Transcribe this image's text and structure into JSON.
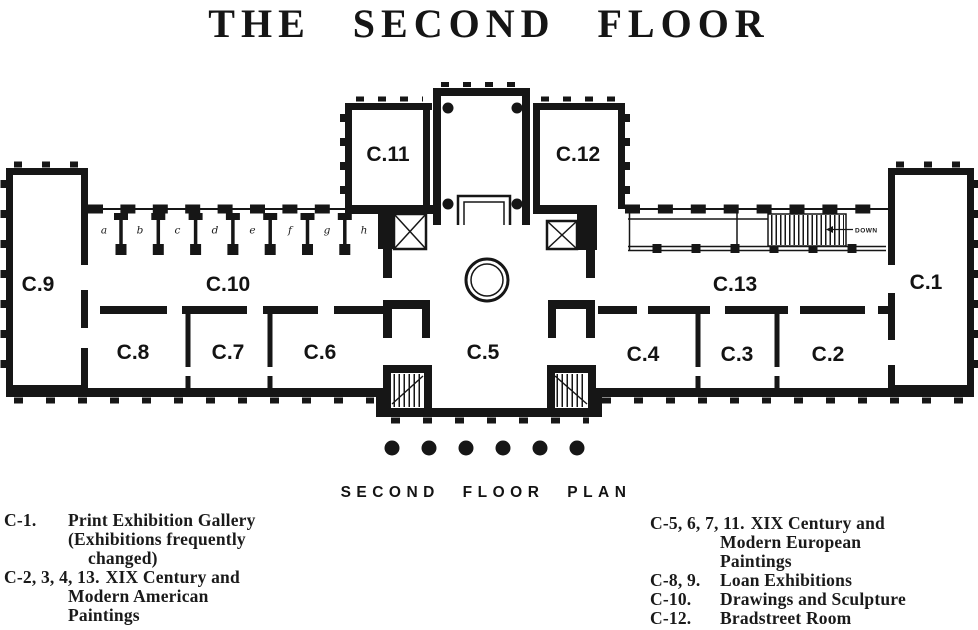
{
  "title": "THE SECOND FLOOR",
  "plan": {
    "caption": "SECOND FLOOR PLAN",
    "rooms": {
      "c1": "C.1",
      "c2": "C.2",
      "c3": "C.3",
      "c4": "C.4",
      "c5": "C.5",
      "c6": "C.6",
      "c7": "C.7",
      "c8": "C.8",
      "c9": "C.9",
      "c10": "C.10",
      "c11": "C.11",
      "c12": "C.12",
      "c13": "C.13"
    },
    "alcove_letters": [
      "a",
      "b",
      "c",
      "d",
      "e",
      "f",
      "g",
      "h"
    ],
    "annotations": {
      "down": "DOWN"
    }
  },
  "legend": {
    "left": [
      {
        "code": "C-1.",
        "line1": "Print Exhibition Gallery",
        "line2": "(Exhibitions frequently",
        "line3": "changed)"
      },
      {
        "code": "C-2, 3, 4, 13.",
        "line1": "XIX Century and",
        "line2": "Modern American",
        "line3": "Paintings"
      }
    ],
    "right": [
      {
        "code": "C-5, 6, 7, 11.",
        "line1": "XIX Century and",
        "line2": "Modern European",
        "line3": "Paintings"
      },
      {
        "code": "C-8, 9.",
        "line1": "Loan Exhibitions"
      },
      {
        "code": "C-10.",
        "line1": "Drawings and Sculpture"
      },
      {
        "code": "C-12.",
        "line1": "Bradstreet Room"
      }
    ]
  },
  "colors": {
    "ink": "#161616",
    "paper": "#ffffff"
  }
}
